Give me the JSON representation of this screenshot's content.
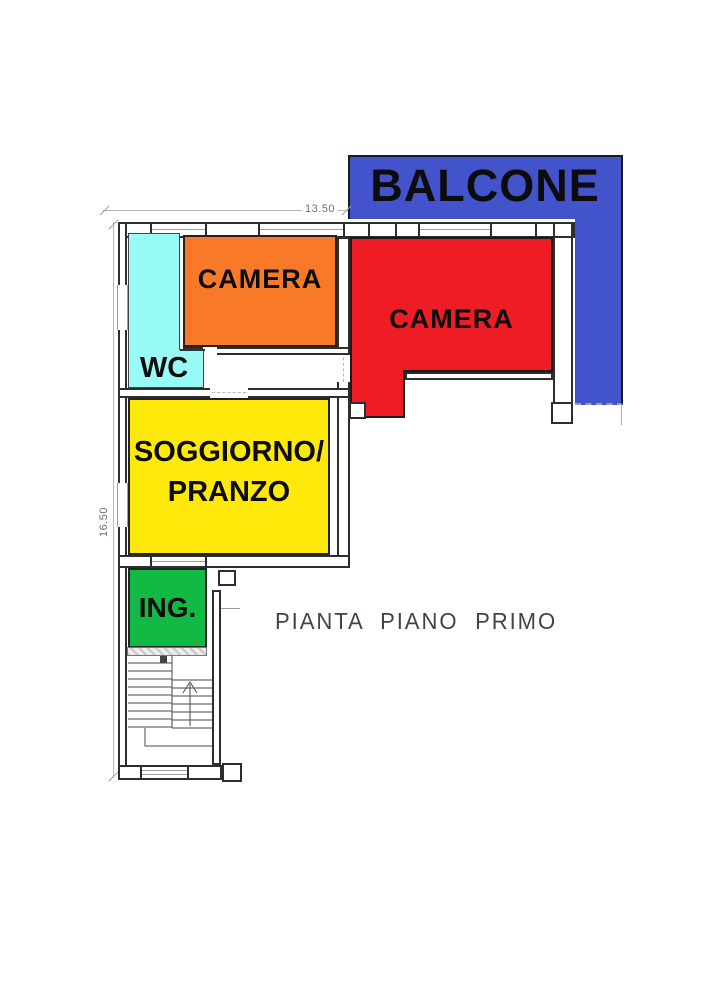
{
  "plan": {
    "title": "PIANTA PIANO PRIMO",
    "dimensions": {
      "width_label": "13.50",
      "height_label": "16.50"
    },
    "rooms": {
      "balcone": {
        "label": "BALCONE",
        "color": "#4353cb"
      },
      "camera_orange": {
        "label": "CAMERA",
        "color": "#f87a28"
      },
      "camera_red": {
        "label": "CAMERA",
        "color": "#ee1c24"
      },
      "wc": {
        "label": "WC",
        "color": "#98fbf6"
      },
      "soggiorno": {
        "line1": "SOGGIORNO/",
        "line2": "PRANZO",
        "color": "#ffe90b"
      },
      "ingresso": {
        "label": "ING.",
        "color": "#12b944"
      }
    },
    "colors": {
      "wall": "#2e2e2e",
      "dimension": "#b3b7ba",
      "label_text": "#0c0c0c"
    }
  }
}
